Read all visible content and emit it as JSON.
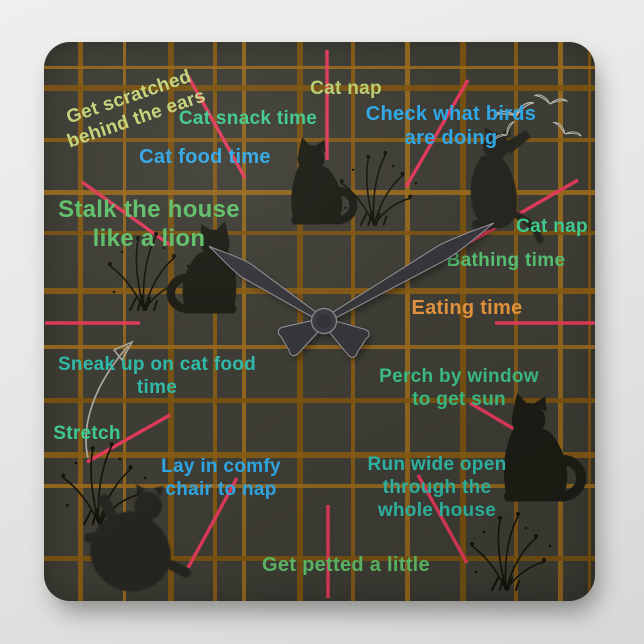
{
  "page": {
    "description_colors": {
      "backdrop": "#e9e9e7",
      "clock_face": "#3e3d35"
    }
  },
  "clock": {
    "face_color": "#3e3d35",
    "tick_color": "#e63a5c",
    "hour_angle_deg": -57,
    "minute_angle_deg": 60,
    "tick_marks": [
      [
        283,
        8,
        283,
        118
      ],
      [
        424,
        38,
        362,
        145
      ],
      [
        534,
        138,
        426,
        200
      ],
      [
        451,
        281,
        554,
        281
      ],
      [
        426,
        361,
        526,
        420
      ],
      [
        374,
        433,
        423,
        521
      ],
      [
        284,
        463,
        284,
        556
      ],
      [
        193,
        436,
        144,
        526
      ],
      [
        126,
        373,
        43,
        420
      ],
      [
        1,
        281,
        96,
        281
      ],
      [
        38,
        140,
        126,
        203
      ],
      [
        144,
        34,
        201,
        136
      ]
    ],
    "plaid": {
      "colors": [
        "#8a5c13",
        "#9a6a1c",
        "#7d530f"
      ],
      "verticals": [
        [
          34,
          5
        ],
        [
          79,
          3
        ],
        [
          124,
          6
        ],
        [
          169,
          4
        ],
        [
          198,
          4
        ],
        [
          253,
          6
        ],
        [
          307,
          4
        ],
        [
          361,
          5
        ],
        [
          416,
          6
        ],
        [
          470,
          4
        ],
        [
          514,
          5
        ],
        [
          544,
          3
        ]
      ],
      "horizontals": [
        [
          24,
          3
        ],
        [
          43,
          6
        ],
        [
          96,
          4
        ],
        [
          148,
          5
        ],
        [
          189,
          4
        ],
        [
          246,
          6
        ],
        [
          303,
          4
        ],
        [
          356,
          5
        ],
        [
          410,
          6
        ],
        [
          442,
          4
        ],
        [
          514,
          5
        ]
      ]
    }
  },
  "labels": {
    "get_scratched": {
      "text": "Get scratched\nbehind the ears",
      "color": "#c5d378"
    },
    "cat_snack": {
      "text": "Cat snack time",
      "color": "#3fc98d"
    },
    "cat_nap_top": {
      "text": "Cat nap",
      "color": "#b8cc70"
    },
    "check_birds": {
      "text": "Check what birds\nare doing",
      "color": "#2fa7e6"
    },
    "cat_food": {
      "text": "Cat food time",
      "color": "#2fa7e6"
    },
    "stalk": {
      "text": "Stalk the house\nlike a lion",
      "color": "#5fbe68"
    },
    "cat_nap_right": {
      "text": "Cat nap",
      "color": "#3fc98d"
    },
    "bathing": {
      "text": "Bathing time",
      "color": "#54bd72"
    },
    "eating": {
      "text": "Eating time",
      "color": "#e2923d"
    },
    "sneak": {
      "text": "Sneak up on cat food\ntime",
      "color": "#30b9a6"
    },
    "stretch": {
      "text": "Stretch",
      "color": "#3fc98d"
    },
    "lay": {
      "text": "Lay in comfy\nchair to nap",
      "color": "#2fa7e6"
    },
    "perch": {
      "text": "Perch by window\nto get sun",
      "color": "#3bbd85"
    },
    "run": {
      "text": "Run wide open\nthrough the\nwhole house",
      "color": "#30b9a6"
    },
    "petted": {
      "text": "Get petted a little",
      "color": "#5fbe68"
    }
  }
}
